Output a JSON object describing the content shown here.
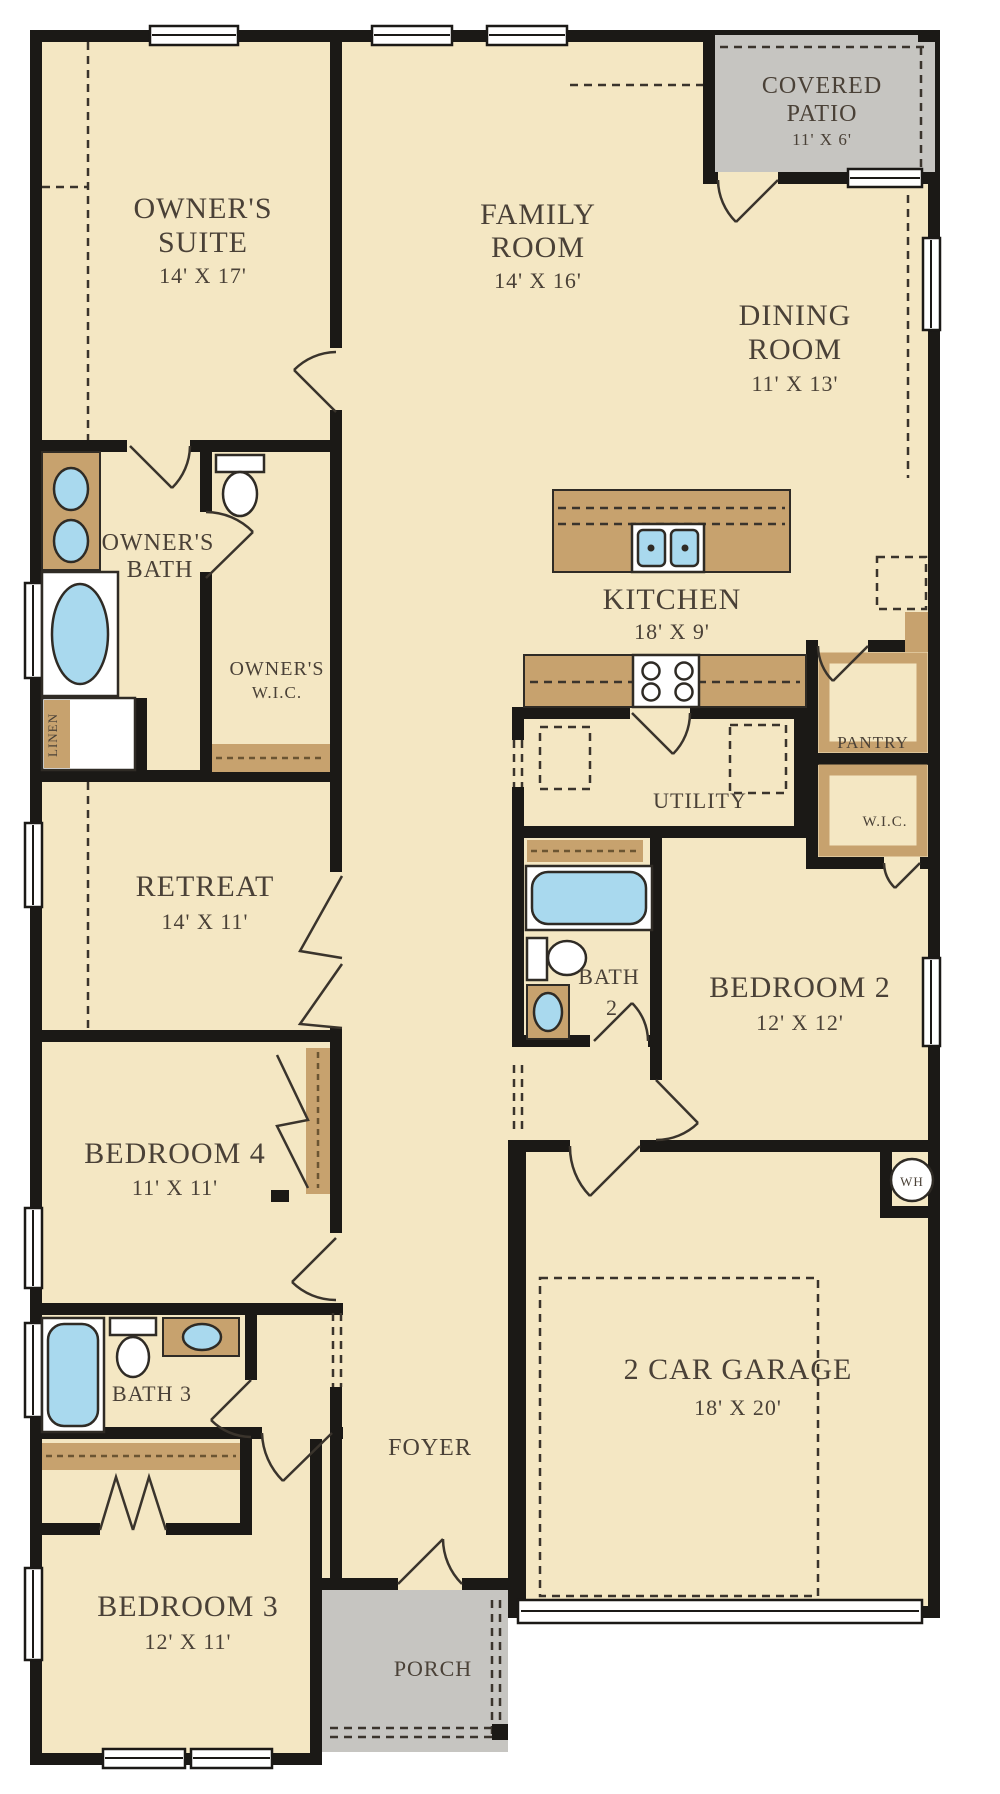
{
  "rooms": {
    "owners_suite": {
      "line1": "OWNER'S",
      "line2": "SUITE",
      "dims": "14' X 17'"
    },
    "family_room": {
      "line1": "FAMILY",
      "line2": "ROOM",
      "dims": "14' X 16'"
    },
    "covered_patio": {
      "line1": "COVERED",
      "line2": "PATIO",
      "dims": "11' X 6'"
    },
    "dining_room": {
      "line1": "DINING",
      "line2": "ROOM",
      "dims": "11' X 13'"
    },
    "kitchen": {
      "line1": "KITCHEN",
      "dims": "18' X 9'"
    },
    "owners_bath": {
      "line1": "OWNER'S",
      "line2": "BATH"
    },
    "owners_wic": {
      "line1": "OWNER'S",
      "line2": "W.I.C."
    },
    "linen": {
      "line1": "LINEN"
    },
    "utility": {
      "line1": "UTILITY"
    },
    "pantry": {
      "line1": "PANTRY"
    },
    "wic_2": {
      "line1": "W.I.C."
    },
    "bath_2": {
      "line1": "BATH",
      "line2": "2"
    },
    "bedroom_2": {
      "line1": "BEDROOM 2",
      "dims": "12' X 12'"
    },
    "retreat": {
      "line1": "RETREAT",
      "dims": "14' X 11'"
    },
    "bedroom_4": {
      "line1": "BEDROOM 4",
      "dims": "11' X 11'"
    },
    "bath_3": {
      "line1": "BATH 3"
    },
    "bedroom_3": {
      "line1": "BEDROOM 3",
      "dims": "12' X 11'"
    },
    "foyer": {
      "line1": "FOYER"
    },
    "porch": {
      "line1": "PORCH"
    },
    "garage": {
      "line1": "2 CAR GARAGE",
      "dims": "18' X 20'"
    },
    "water_heater": {
      "line1": "WH"
    }
  },
  "colors": {
    "floor": "#f4e7c3",
    "counter": "#c7a26e",
    "concrete": "#c6c5c1",
    "water": "#a9d9ee",
    "wall": "#1b1916",
    "text": "#4a4137"
  }
}
